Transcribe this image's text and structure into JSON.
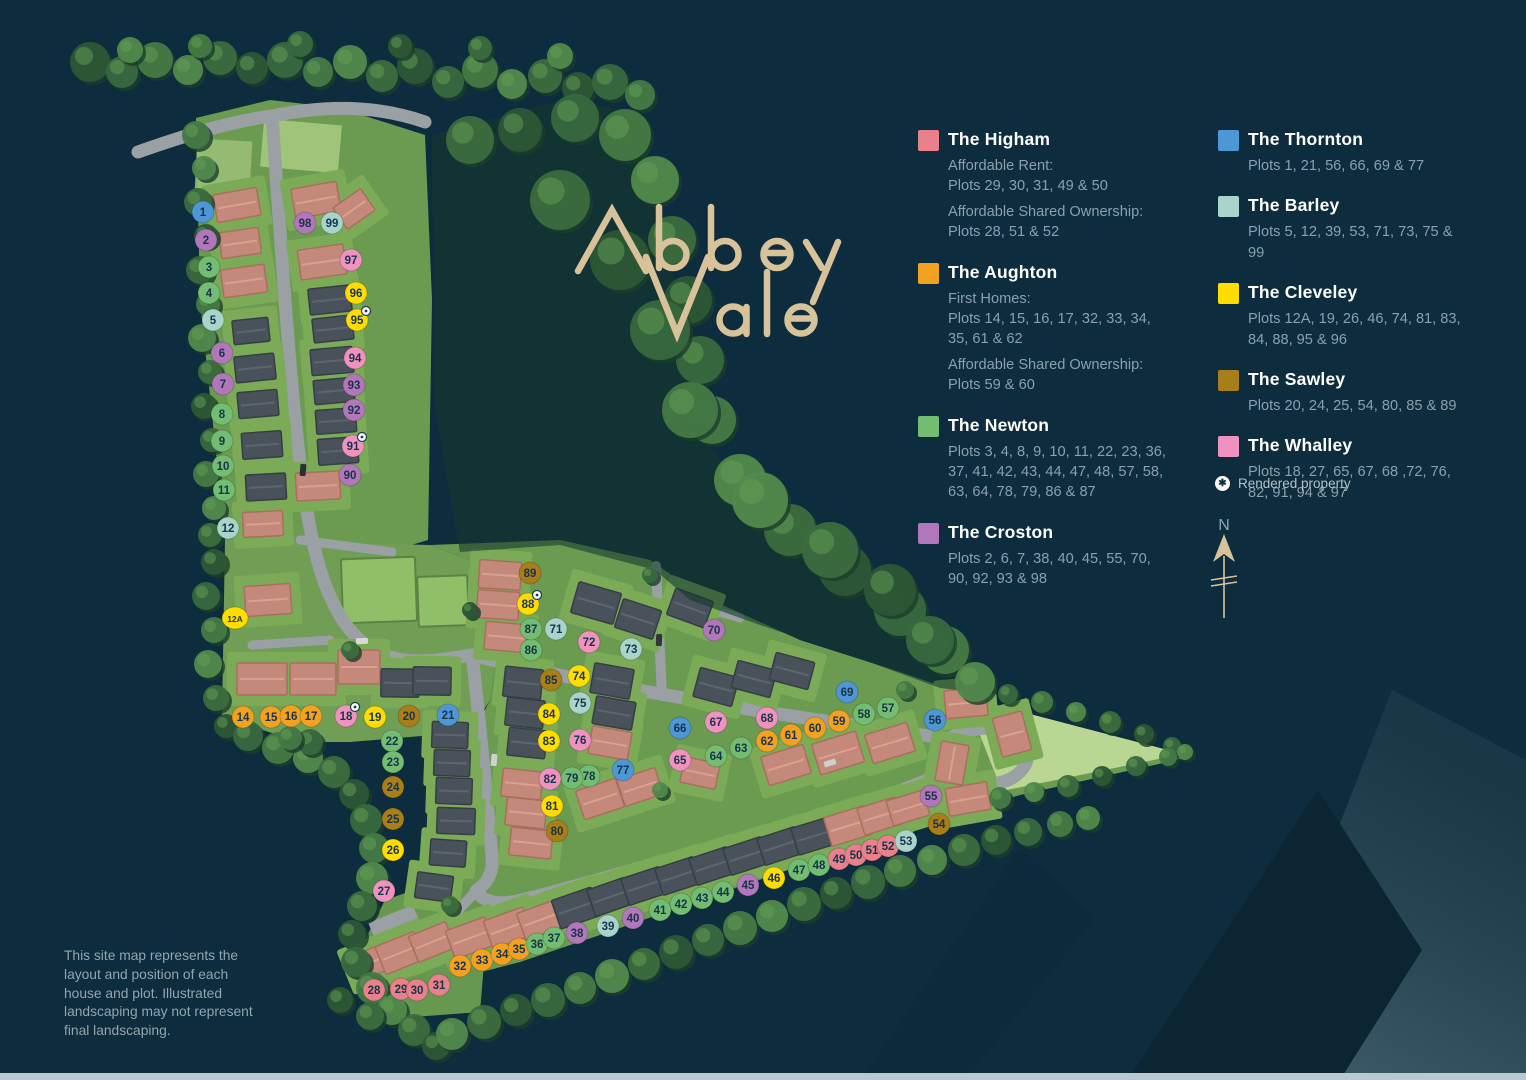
{
  "site_name": "Abbey Vale",
  "logo": {
    "word1": "Abbey",
    "word2": "Vale"
  },
  "house_type_colors": {
    "higham": "#e8818c",
    "aughton": "#f2a121",
    "newton": "#72bd72",
    "croston": "#b277bb",
    "thornton": "#4e97d6",
    "barley": "#a9d4cc",
    "cleveley": "#ffdd00",
    "sawley": "#a97e18",
    "whalley": "#f092c0"
  },
  "legend": {
    "columns": [
      {
        "items": [
          {
            "name": "The Higham",
            "type": "higham",
            "sections": [
              {
                "label": "Affordable Rent:",
                "plots": "Plots 29, 30, 31, 49 & 50"
              },
              {
                "label": "Affordable Shared Ownership:",
                "plots": "Plots 28, 51 & 52"
              }
            ]
          },
          {
            "name": "The Aughton",
            "type": "aughton",
            "sections": [
              {
                "label": "First Homes:",
                "plots": "Plots 14, 15, 16, 17, 32, 33, 34, 35, 61 & 62"
              },
              {
                "label": "Affordable Shared Ownership:",
                "plots": "Plots 59 & 60"
              }
            ]
          },
          {
            "name": "The Newton",
            "type": "newton",
            "sections": [
              {
                "plots": "Plots 3, 4, 8, 9, 10, 11, 22, 23, 36, 37, 41, 42, 43, 44, 47, 48, 57, 58, 63, 64, 78, 79, 86 & 87"
              }
            ]
          },
          {
            "name": "The Croston",
            "type": "croston",
            "sections": [
              {
                "plots": "Plots 2, 6, 7, 38, 40, 45, 55, 70, 90, 92, 93 & 98"
              }
            ]
          }
        ]
      },
      {
        "items": [
          {
            "name": "The Thornton",
            "type": "thornton",
            "sections": [
              {
                "plots": "Plots 1, 21, 56, 66, 69 & 77"
              }
            ]
          },
          {
            "name": "The Barley",
            "type": "barley",
            "sections": [
              {
                "plots": "Plots 5, 12, 39, 53, 71, 73, 75 & 99"
              }
            ]
          },
          {
            "name": "The Cleveley",
            "type": "cleveley",
            "sections": [
              {
                "plots": "Plots 12A, 19, 26, 46, 74, 81, 83, 84, 88, 95 & 96"
              }
            ]
          },
          {
            "name": "The Sawley",
            "type": "sawley",
            "sections": [
              {
                "plots": "Plots 20, 24, 25, 54, 80, 85 & 89"
              }
            ]
          },
          {
            "name": "The Whalley",
            "type": "whalley",
            "sections": [
              {
                "plots": "Plots 18, 27, 65, 67, 68 ,72, 76, 82, 91, 94 & 97"
              }
            ]
          }
        ]
      }
    ],
    "rendered_property_label": "Rendered property",
    "rendered_icon_glyph": "✱"
  },
  "compass": {
    "north_label": "N"
  },
  "disclaimer": "This site map represents the layout and position of each house and plot. Illustrated landscaping may not represent final landscaping.",
  "plots": [
    {
      "n": "1",
      "type": "thornton",
      "x": 203,
      "y": 212
    },
    {
      "n": "2",
      "type": "croston",
      "x": 206,
      "y": 240
    },
    {
      "n": "3",
      "type": "newton",
      "x": 209,
      "y": 267
    },
    {
      "n": "4",
      "type": "newton",
      "x": 209,
      "y": 293
    },
    {
      "n": "5",
      "type": "barley",
      "x": 213,
      "y": 320
    },
    {
      "n": "6",
      "type": "croston",
      "x": 222,
      "y": 353
    },
    {
      "n": "7",
      "type": "croston",
      "x": 223,
      "y": 384
    },
    {
      "n": "8",
      "type": "newton",
      "x": 222,
      "y": 414
    },
    {
      "n": "9",
      "type": "newton",
      "x": 222,
      "y": 441
    },
    {
      "n": "10",
      "type": "newton",
      "x": 223,
      "y": 466
    },
    {
      "n": "11",
      "type": "newton",
      "x": 224,
      "y": 490
    },
    {
      "n": "12",
      "type": "barley",
      "x": 228,
      "y": 528
    },
    {
      "n": "12A",
      "type": "cleveley",
      "x": 235,
      "y": 618
    },
    {
      "n": "14",
      "type": "aughton",
      "x": 243,
      "y": 717
    },
    {
      "n": "15",
      "type": "aughton",
      "x": 271,
      "y": 717
    },
    {
      "n": "16",
      "type": "aughton",
      "x": 291,
      "y": 716
    },
    {
      "n": "17",
      "type": "aughton",
      "x": 311,
      "y": 716
    },
    {
      "n": "18",
      "type": "whalley",
      "x": 346,
      "y": 716,
      "rendered": true
    },
    {
      "n": "19",
      "type": "cleveley",
      "x": 375,
      "y": 717
    },
    {
      "n": "20",
      "type": "sawley",
      "x": 409,
      "y": 716
    },
    {
      "n": "21",
      "type": "thornton",
      "x": 448,
      "y": 715
    },
    {
      "n": "22",
      "type": "newton",
      "x": 392,
      "y": 741
    },
    {
      "n": "23",
      "type": "newton",
      "x": 393,
      "y": 762
    },
    {
      "n": "24",
      "type": "sawley",
      "x": 393,
      "y": 787
    },
    {
      "n": "25",
      "type": "sawley",
      "x": 393,
      "y": 819
    },
    {
      "n": "26",
      "type": "cleveley",
      "x": 393,
      "y": 850
    },
    {
      "n": "27",
      "type": "whalley",
      "x": 384,
      "y": 891
    },
    {
      "n": "28",
      "type": "higham",
      "x": 374,
      "y": 990
    },
    {
      "n": "29",
      "type": "higham",
      "x": 401,
      "y": 989
    },
    {
      "n": "30",
      "type": "higham",
      "x": 417,
      "y": 990
    },
    {
      "n": "31",
      "type": "higham",
      "x": 439,
      "y": 985
    },
    {
      "n": "32",
      "type": "aughton",
      "x": 460,
      "y": 966
    },
    {
      "n": "33",
      "type": "aughton",
      "x": 482,
      "y": 960
    },
    {
      "n": "34",
      "type": "aughton",
      "x": 502,
      "y": 954
    },
    {
      "n": "35",
      "type": "aughton",
      "x": 519,
      "y": 949
    },
    {
      "n": "36",
      "type": "newton",
      "x": 537,
      "y": 944
    },
    {
      "n": "37",
      "type": "newton",
      "x": 554,
      "y": 938
    },
    {
      "n": "38",
      "type": "croston",
      "x": 577,
      "y": 933
    },
    {
      "n": "39",
      "type": "barley",
      "x": 608,
      "y": 926
    },
    {
      "n": "40",
      "type": "croston",
      "x": 633,
      "y": 918
    },
    {
      "n": "41",
      "type": "newton",
      "x": 660,
      "y": 910
    },
    {
      "n": "42",
      "type": "newton",
      "x": 681,
      "y": 904
    },
    {
      "n": "43",
      "type": "newton",
      "x": 702,
      "y": 898
    },
    {
      "n": "44",
      "type": "newton",
      "x": 723,
      "y": 892
    },
    {
      "n": "45",
      "type": "croston",
      "x": 748,
      "y": 885
    },
    {
      "n": "46",
      "type": "cleveley",
      "x": 774,
      "y": 878
    },
    {
      "n": "47",
      "type": "newton",
      "x": 799,
      "y": 870
    },
    {
      "n": "48",
      "type": "newton",
      "x": 819,
      "y": 865
    },
    {
      "n": "49",
      "type": "higham",
      "x": 839,
      "y": 859
    },
    {
      "n": "50",
      "type": "higham",
      "x": 856,
      "y": 855
    },
    {
      "n": "51",
      "type": "higham",
      "x": 872,
      "y": 850
    },
    {
      "n": "52",
      "type": "higham",
      "x": 888,
      "y": 846
    },
    {
      "n": "53",
      "type": "barley",
      "x": 906,
      "y": 841
    },
    {
      "n": "54",
      "type": "sawley",
      "x": 939,
      "y": 824
    },
    {
      "n": "55",
      "type": "croston",
      "x": 931,
      "y": 796
    },
    {
      "n": "56",
      "type": "thornton",
      "x": 935,
      "y": 720
    },
    {
      "n": "57",
      "type": "newton",
      "x": 888,
      "y": 708
    },
    {
      "n": "58",
      "type": "newton",
      "x": 864,
      "y": 714
    },
    {
      "n": "59",
      "type": "aughton",
      "x": 839,
      "y": 721
    },
    {
      "n": "60",
      "type": "aughton",
      "x": 815,
      "y": 728
    },
    {
      "n": "61",
      "type": "aughton",
      "x": 791,
      "y": 735
    },
    {
      "n": "62",
      "type": "aughton",
      "x": 767,
      "y": 741
    },
    {
      "n": "63",
      "type": "newton",
      "x": 741,
      "y": 748
    },
    {
      "n": "64",
      "type": "newton",
      "x": 716,
      "y": 756
    },
    {
      "n": "65",
      "type": "whalley",
      "x": 680,
      "y": 760
    },
    {
      "n": "66",
      "type": "thornton",
      "x": 680,
      "y": 728
    },
    {
      "n": "67",
      "type": "whalley",
      "x": 716,
      "y": 722
    },
    {
      "n": "68",
      "type": "whalley",
      "x": 767,
      "y": 718
    },
    {
      "n": "69",
      "type": "thornton",
      "x": 847,
      "y": 692
    },
    {
      "n": "70",
      "type": "croston",
      "x": 714,
      "y": 630
    },
    {
      "n": "71",
      "type": "barley",
      "x": 556,
      "y": 629
    },
    {
      "n": "72",
      "type": "whalley",
      "x": 589,
      "y": 642
    },
    {
      "n": "73",
      "type": "barley",
      "x": 631,
      "y": 649
    },
    {
      "n": "74",
      "type": "cleveley",
      "x": 579,
      "y": 676
    },
    {
      "n": "75",
      "type": "barley",
      "x": 580,
      "y": 703
    },
    {
      "n": "76",
      "type": "whalley",
      "x": 580,
      "y": 740
    },
    {
      "n": "77",
      "type": "thornton",
      "x": 623,
      "y": 770
    },
    {
      "n": "78",
      "type": "newton",
      "x": 589,
      "y": 776
    },
    {
      "n": "79",
      "type": "newton",
      "x": 572,
      "y": 778
    },
    {
      "n": "80",
      "type": "sawley",
      "x": 557,
      "y": 831
    },
    {
      "n": "81",
      "type": "cleveley",
      "x": 552,
      "y": 806
    },
    {
      "n": "82",
      "type": "whalley",
      "x": 550,
      "y": 779
    },
    {
      "n": "83",
      "type": "cleveley",
      "x": 549,
      "y": 741
    },
    {
      "n": "84",
      "type": "cleveley",
      "x": 549,
      "y": 714
    },
    {
      "n": "85",
      "type": "sawley",
      "x": 551,
      "y": 680
    },
    {
      "n": "86",
      "type": "newton",
      "x": 531,
      "y": 650
    },
    {
      "n": "87",
      "type": "newton",
      "x": 531,
      "y": 629
    },
    {
      "n": "88",
      "type": "cleveley",
      "x": 528,
      "y": 604,
      "rendered": true
    },
    {
      "n": "89",
      "type": "sawley",
      "x": 530,
      "y": 573
    },
    {
      "n": "90",
      "type": "croston",
      "x": 350,
      "y": 475
    },
    {
      "n": "91",
      "type": "whalley",
      "x": 353,
      "y": 446,
      "rendered": true
    },
    {
      "n": "92",
      "type": "croston",
      "x": 354,
      "y": 410
    },
    {
      "n": "93",
      "type": "croston",
      "x": 354,
      "y": 385
    },
    {
      "n": "94",
      "type": "whalley",
      "x": 355,
      "y": 358
    },
    {
      "n": "95",
      "type": "cleveley",
      "x": 357,
      "y": 320,
      "rendered": true
    },
    {
      "n": "96",
      "type": "cleveley",
      "x": 356,
      "y": 293
    },
    {
      "n": "97",
      "type": "whalley",
      "x": 351,
      "y": 260
    },
    {
      "n": "98",
      "type": "croston",
      "x": 305,
      "y": 223
    },
    {
      "n": "99",
      "type": "barley",
      "x": 332,
      "y": 223
    }
  ]
}
